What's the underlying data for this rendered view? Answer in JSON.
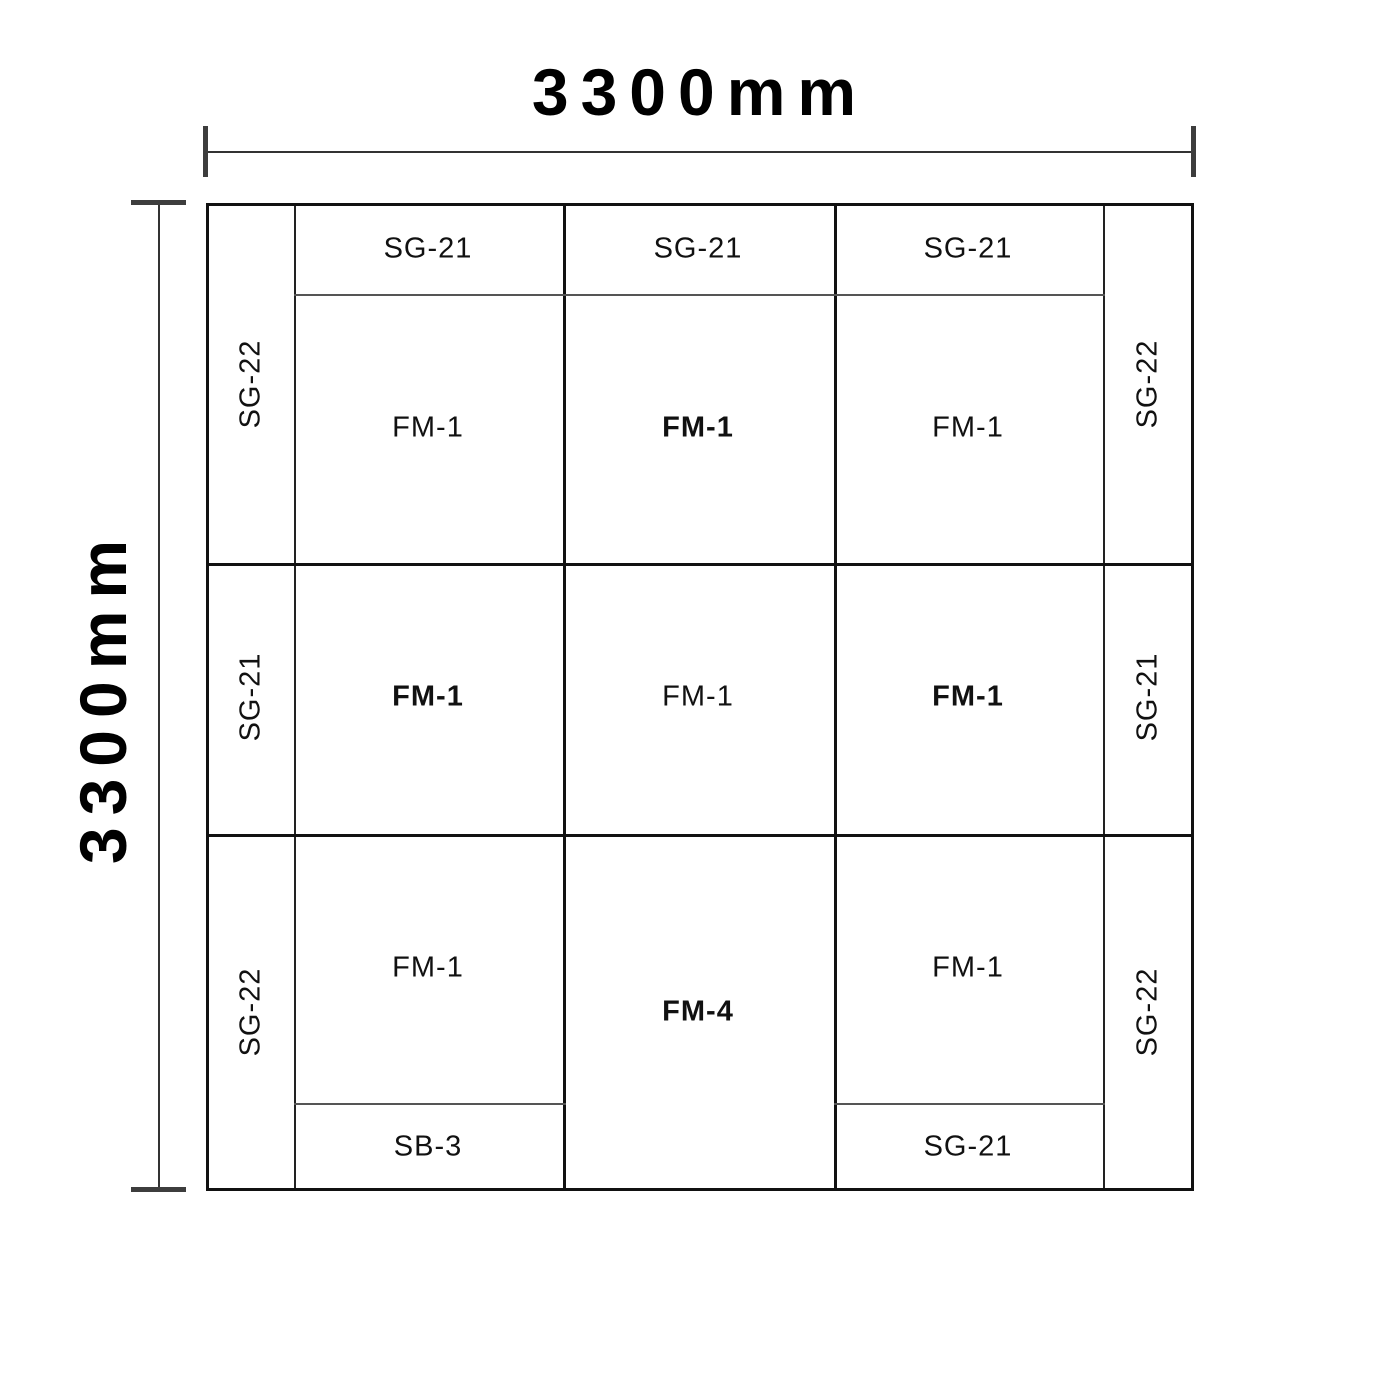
{
  "colors": {
    "line": "#111111",
    "thin_line": "#555555",
    "dimension": "#3a3a3a",
    "text": "#111111",
    "background": "#ffffff"
  },
  "dimensions": {
    "top_label": "3300mm",
    "left_label": "3300mm"
  },
  "labels": {
    "strip_top_1": "SG-21",
    "strip_top_2": "SG-21",
    "strip_top_3": "SG-21",
    "side_left_top": "SG-22",
    "side_left_mid": "SG-21",
    "side_left_bot": "SG-22",
    "side_right_top": "SG-22",
    "side_right_mid": "SG-21",
    "side_right_bot": "SG-22",
    "cell_r1c1": "FM-1",
    "cell_r1c2": "FM-1",
    "cell_r1c3": "FM-1",
    "cell_r2c1": "FM-1",
    "cell_r2c2": "FM-1",
    "cell_r2c3": "FM-1",
    "cell_r3c1": "FM-1",
    "cell_r3c2": "FM-4",
    "cell_r3c3": "FM-1",
    "strip_bot_left": "SB-3",
    "strip_bot_right": "SG-21"
  }
}
